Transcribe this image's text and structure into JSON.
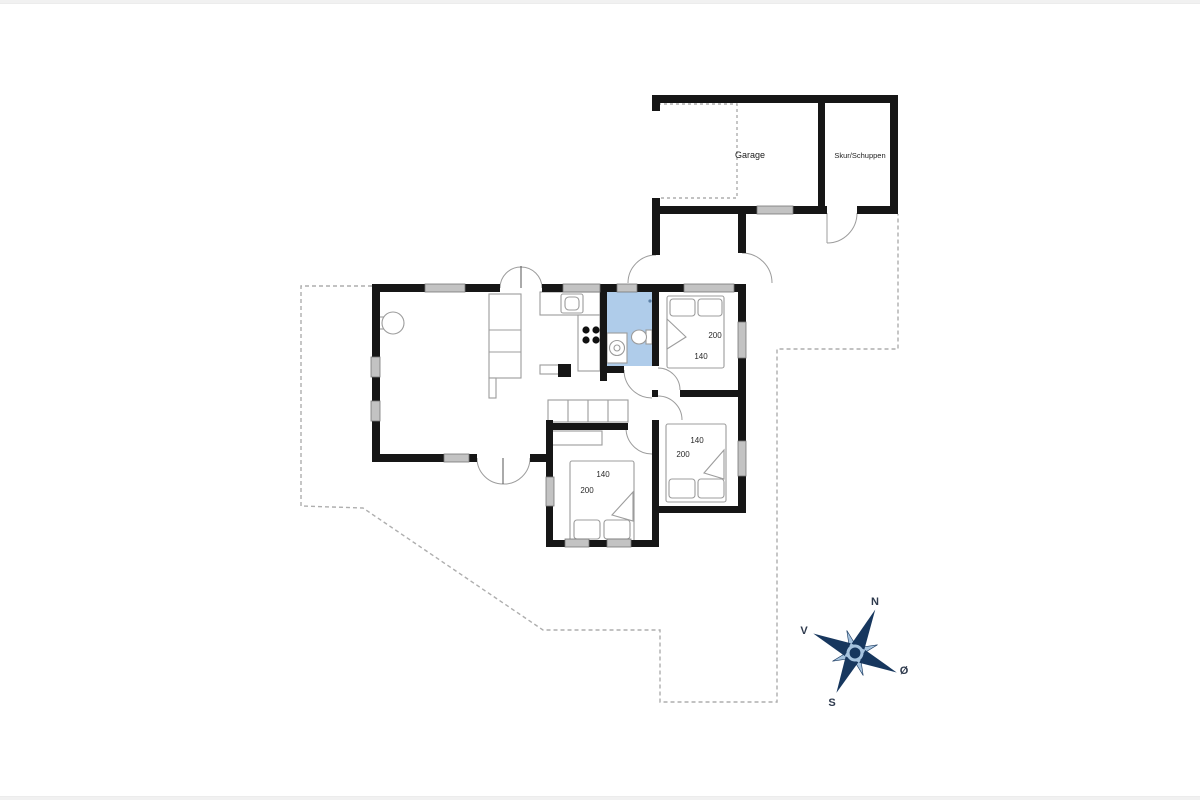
{
  "plan": {
    "labels": {
      "garage": "Garage",
      "shed": "Skur/Schuppen"
    },
    "beds": [
      {
        "room": "bedroom-northeast",
        "length": "200",
        "width": "140"
      },
      {
        "room": "bedroom-east",
        "length": "200",
        "width": "140"
      },
      {
        "room": "bedroom-south",
        "length": "200",
        "width": "140"
      }
    ],
    "compass": {
      "n": "N",
      "s": "S",
      "w": "V",
      "e": "Ø"
    },
    "colors": {
      "wall": "#161616",
      "window_fill": "#c3c3c3",
      "bathroom_fill": "#afccea",
      "furniture_line": "#9c9c9c",
      "dashed_line": "#aeaeae",
      "compass_dark": "#17375e",
      "compass_light": "#a6c3de",
      "label_text": "#2e3a4d"
    }
  }
}
